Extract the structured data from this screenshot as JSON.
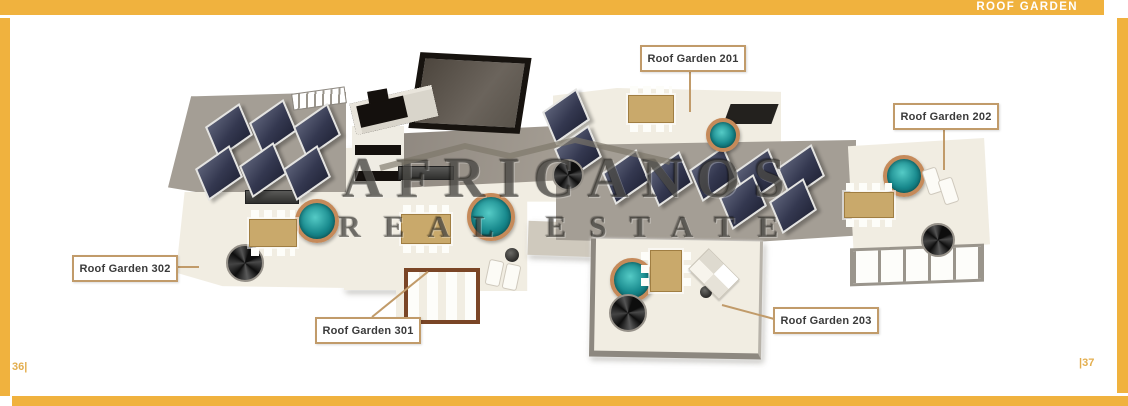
{
  "header": {
    "title": "ROOF GARDEN"
  },
  "watermark": {
    "line1": "AFRICANOS",
    "line2": "REAL ESTATE",
    "icon": "house-roofline-logo"
  },
  "labels": [
    {
      "text": "Roof Garden 201"
    },
    {
      "text": "Roof Garden 202"
    },
    {
      "text": "Roof Garden 302"
    },
    {
      "text": "Roof Garden 301"
    },
    {
      "text": "Roof Garden 203"
    }
  ],
  "footer": {
    "left_page_number": "36|",
    "right_page_number": "|37"
  },
  "illustration": {
    "description": "3D axonometric roof-level floor plan with solar panels, hot tubs, spiral staircases, dining tables, pergolas and sun decks"
  },
  "colors": {
    "accent_gold": "#F0B23E",
    "label_border_tan": "#C19B6A",
    "page_number_gold": "#E3AE4E",
    "deck_cream": "#F1EDE2",
    "concrete_gray": "#A49E95",
    "solar_panel_navy": "#343850",
    "hot_tub_teal": "#17888C",
    "hot_tub_rim_copper": "#C58A5A",
    "roof_dark": "#17130F"
  }
}
